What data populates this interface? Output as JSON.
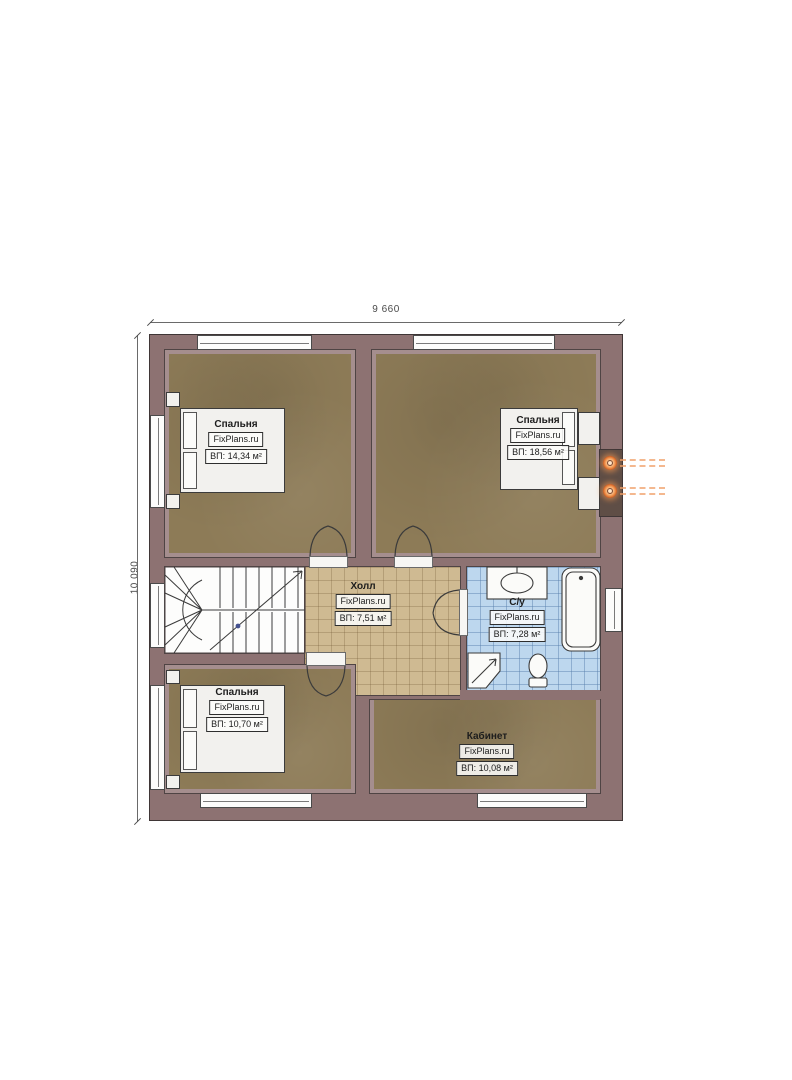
{
  "plan": {
    "dimensions": {
      "width": "9 660",
      "height": "10 090"
    },
    "rooms": [
      {
        "name": "Спальня",
        "brand": "FixPlans.ru",
        "area": "ВП: 14,34 м²"
      },
      {
        "name": "Спальня",
        "brand": "FixPlans.ru",
        "area": "ВП: 18,56 м²"
      },
      {
        "name": "Холл",
        "brand": "FixPlans.ru",
        "area": "ВП: 7,51 м²"
      },
      {
        "name": "С/у",
        "brand": "FixPlans.ru",
        "area": "ВП: 7,28 м²"
      },
      {
        "name": "Спальня",
        "brand": "FixPlans.ru",
        "area": "ВП: 10,70 м²"
      },
      {
        "name": "Кабинет",
        "brand": "FixPlans.ru",
        "area": "ВП: 10,08 м²"
      }
    ],
    "colors": {
      "wall": "#8d7272",
      "bedroom_floor": "#8d7b57",
      "hall_floor": "#cfba92",
      "bathroom_floor": "#bdd7ee",
      "sconce_accent": "#e8833a",
      "line": "#3b3b3b"
    }
  }
}
